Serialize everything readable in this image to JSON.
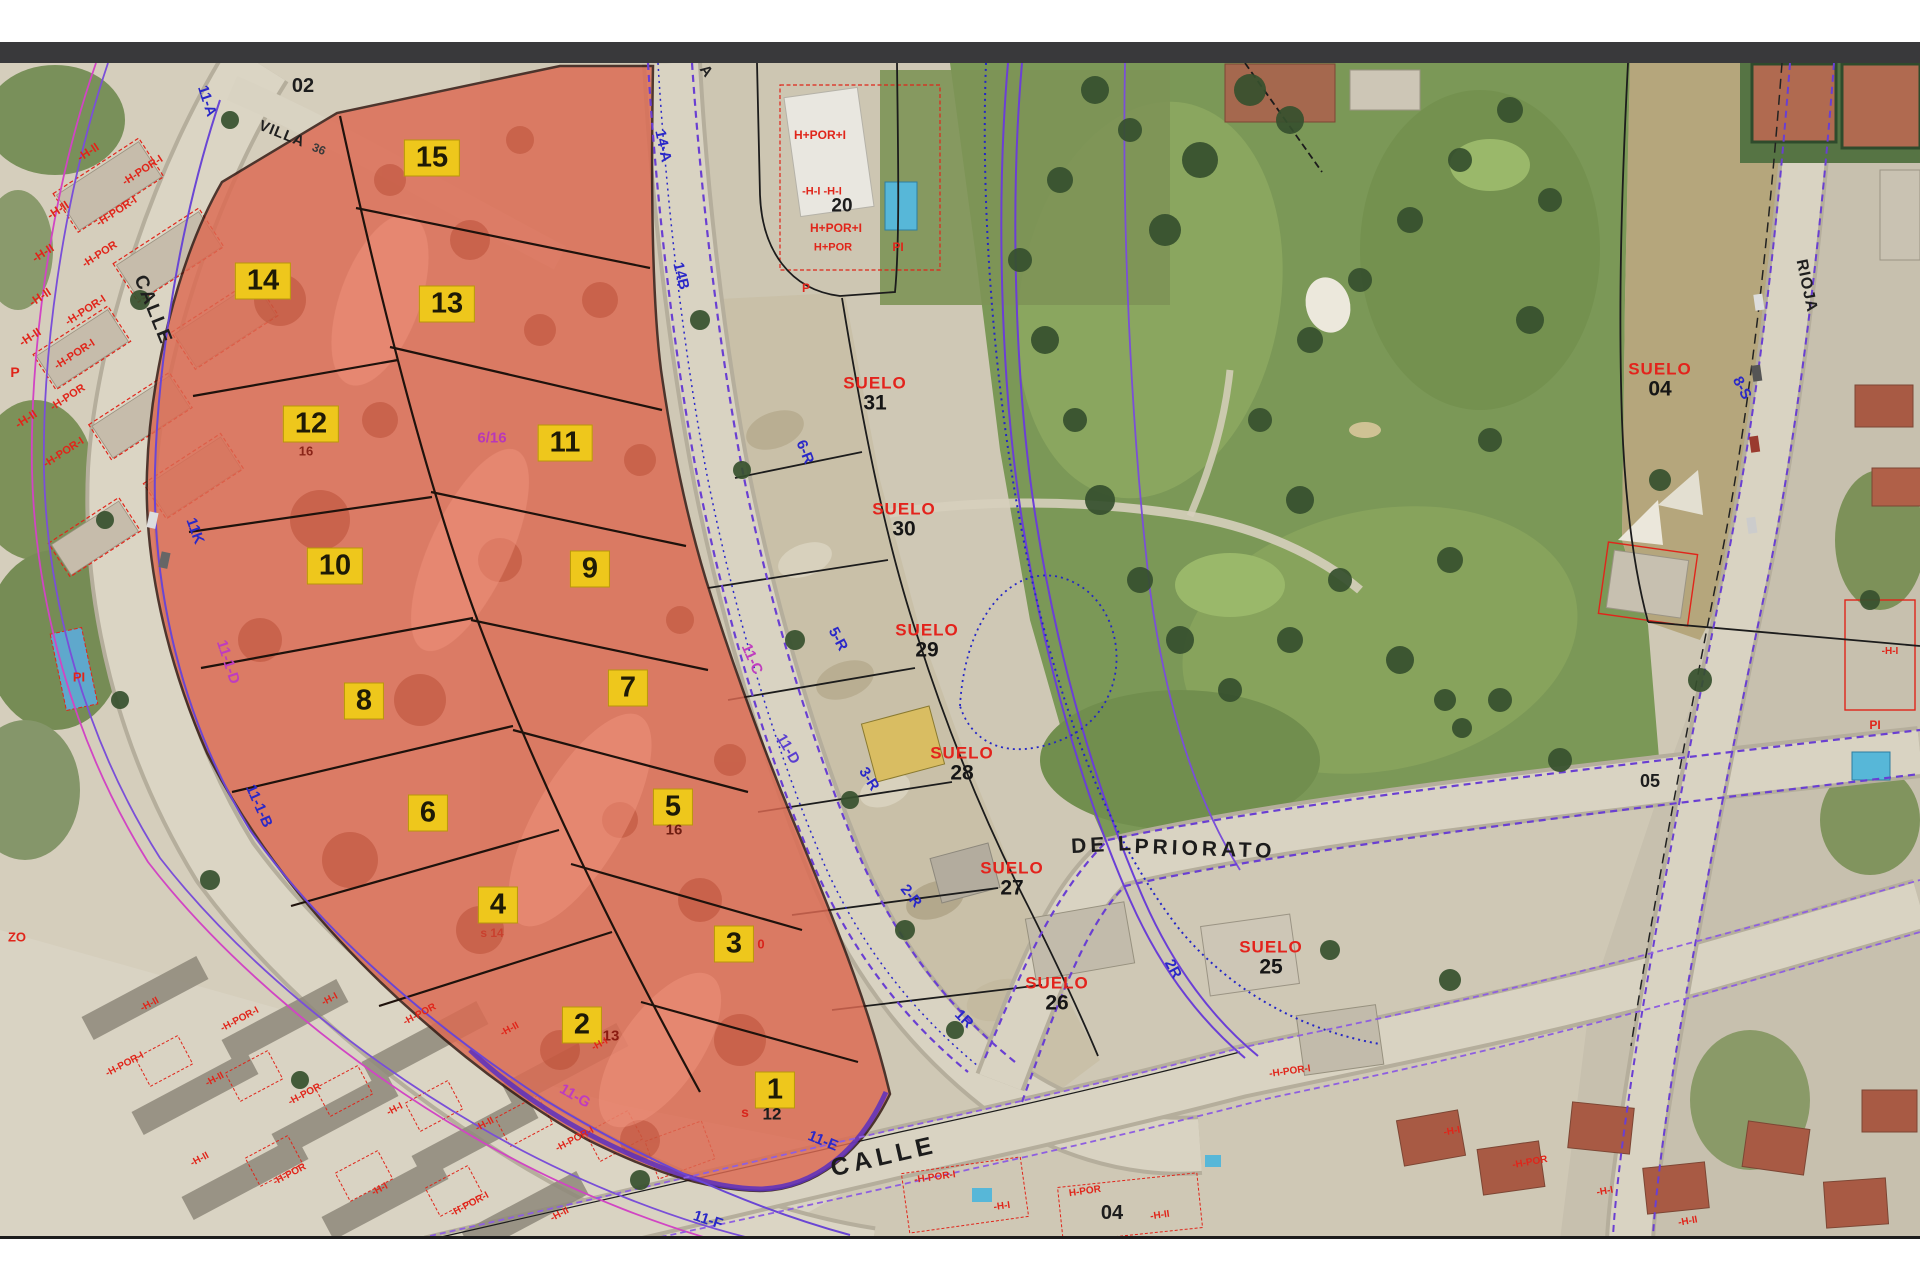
{
  "window": {
    "top_strip_color": "#ffffff",
    "title_bar_color": "#39393b"
  },
  "colors": {
    "highlight_polygon": "#dd6a52",
    "parcel_label_bg": "#eec71c",
    "suelo_red": "#e3231c",
    "code_blue": "#2a28c8",
    "code_magenta": "#bf3cbf",
    "overlay_purple": "#7a4fd8",
    "overlay_magenta": "#d145c4",
    "cadastral_red": "#e0251a"
  },
  "map": {
    "parcel_labels": [
      {
        "n": "1",
        "x": 775,
        "y": 1090
      },
      {
        "n": "2",
        "x": 582,
        "y": 1025
      },
      {
        "n": "3",
        "x": 734,
        "y": 944
      },
      {
        "n": "4",
        "x": 498,
        "y": 905
      },
      {
        "n": "5",
        "x": 673,
        "y": 807
      },
      {
        "n": "6",
        "x": 428,
        "y": 813
      },
      {
        "n": "7",
        "x": 628,
        "y": 688
      },
      {
        "n": "8",
        "x": 364,
        "y": 701
      },
      {
        "n": "9",
        "x": 590,
        "y": 569
      },
      {
        "n": "10",
        "x": 335,
        "y": 566
      },
      {
        "n": "11",
        "x": 565,
        "y": 443
      },
      {
        "n": "12",
        "x": 311,
        "y": 424
      },
      {
        "n": "13",
        "x": 447,
        "y": 304
      },
      {
        "n": "14",
        "x": 263,
        "y": 281
      },
      {
        "n": "15",
        "x": 432,
        "y": 158
      }
    ],
    "parcel_sub_numbers": [
      {
        "text": "6/16",
        "x": 492,
        "y": 438,
        "color": "#b838b8",
        "size": 15,
        "rot": 0
      },
      {
        "text": "16",
        "x": 306,
        "y": 451,
        "color": "#8a2417",
        "size": 13,
        "rot": 0
      },
      {
        "text": "16",
        "x": 674,
        "y": 830,
        "color": "#6e1d12",
        "size": 15,
        "rot": 0
      },
      {
        "text": "0",
        "x": 761,
        "y": 944,
        "color": "#d8251c",
        "size": 13,
        "rot": 0
      },
      {
        "text": "13",
        "x": 611,
        "y": 1036,
        "color": "#8a1a10",
        "size": 15,
        "rot": 0
      },
      {
        "text": "s 14",
        "x": 492,
        "y": 933,
        "color": "#c9402e",
        "size": 12,
        "rot": 0
      },
      {
        "text": "s",
        "x": 745,
        "y": 1112,
        "color": "#d8251c",
        "size": 14,
        "rot": 0
      },
      {
        "text": "12",
        "x": 772,
        "y": 1114,
        "color": "#1d1d1d",
        "size": 17,
        "rot": 0
      }
    ],
    "suelo_labels": [
      {
        "word": "SUELO",
        "num": "31",
        "x": 875,
        "y": 394
      },
      {
        "word": "SUELO",
        "num": "30",
        "x": 904,
        "y": 520
      },
      {
        "word": "SUELO",
        "num": "29",
        "x": 927,
        "y": 641
      },
      {
        "word": "SUELO",
        "num": "28",
        "x": 962,
        "y": 764
      },
      {
        "word": "SUELO",
        "num": "27",
        "x": 1012,
        "y": 879
      },
      {
        "word": "SUELO",
        "num": "26",
        "x": 1057,
        "y": 994
      },
      {
        "word": "SUELO",
        "num": "25",
        "x": 1271,
        "y": 958
      },
      {
        "word": "SUELO",
        "num": "04",
        "x": 1660,
        "y": 380
      }
    ],
    "street_labels": [
      {
        "text": "CALLE",
        "x": 153,
        "y": 310,
        "rot": 68,
        "size": 19,
        "spacing": 2,
        "color": "#1f1f1f"
      },
      {
        "text": "VILLA",
        "x": 282,
        "y": 134,
        "rot": 22,
        "size": 15,
        "spacing": 1,
        "color": "#1f1f1f"
      },
      {
        "text": "CALLE",
        "x": 884,
        "y": 1157,
        "rot": -13,
        "size": 25,
        "spacing": 5,
        "color": "#1c1c1c"
      },
      {
        "text": "DE L",
        "x": 1103,
        "y": 845,
        "rot": -3,
        "size": 21,
        "spacing": 4,
        "color": "#1c1c1c"
      },
      {
        "text": "PRIORATO",
        "x": 1205,
        "y": 849,
        "rot": 2,
        "size": 21,
        "spacing": 4,
        "color": "#1c1c1c"
      },
      {
        "text": "RIOJA",
        "x": 1806,
        "y": 286,
        "rot": 78,
        "size": 16,
        "spacing": 1,
        "color": "#1f1f1f"
      }
    ],
    "misc_labels": [
      {
        "text": "02",
        "x": 303,
        "y": 86,
        "size": 20,
        "color": "#1d1d1d",
        "rot": 0
      },
      {
        "text": "20",
        "x": 842,
        "y": 206,
        "size": 19,
        "color": "#1d1d1d",
        "rot": 0
      },
      {
        "text": "04",
        "x": 1112,
        "y": 1213,
        "size": 20,
        "color": "#1d1d1d",
        "rot": 0
      },
      {
        "text": "05",
        "x": 1650,
        "y": 781,
        "size": 18,
        "color": "#1d1d1d",
        "rot": 0
      },
      {
        "text": "36",
        "x": 319,
        "y": 149,
        "size": 12,
        "color": "#3a3a3a",
        "rot": 22
      },
      {
        "text": "A",
        "x": 706,
        "y": 71,
        "size": 15,
        "color": "#222222",
        "rot": 55
      }
    ],
    "road_codes": [
      {
        "text": "11-A",
        "x": 207,
        "y": 101,
        "rot": 72,
        "color": "#2a28c8"
      },
      {
        "text": "11K",
        "x": 195,
        "y": 531,
        "rot": 70,
        "color": "#2a28c8"
      },
      {
        "text": "11-1-D",
        "x": 228,
        "y": 662,
        "rot": 72,
        "color": "#bf3cbf"
      },
      {
        "text": "11-1-B",
        "x": 259,
        "y": 806,
        "rot": 66,
        "color": "#2a28c8"
      },
      {
        "text": "14-A",
        "x": 663,
        "y": 146,
        "rot": 78,
        "color": "#2a28c8"
      },
      {
        "text": "14B",
        "x": 681,
        "y": 276,
        "rot": 76,
        "color": "#2a28c8"
      },
      {
        "text": "6-R",
        "x": 805,
        "y": 452,
        "rot": 68,
        "color": "#2a28c8"
      },
      {
        "text": "5-R",
        "x": 838,
        "y": 639,
        "rot": 62,
        "color": "#2a28c8"
      },
      {
        "text": "3-R",
        "x": 869,
        "y": 779,
        "rot": 58,
        "color": "#2a28c8"
      },
      {
        "text": "2-R",
        "x": 911,
        "y": 896,
        "rot": 52,
        "color": "#2a28c8"
      },
      {
        "text": "1R",
        "x": 964,
        "y": 1019,
        "rot": 45,
        "color": "#2a28c8"
      },
      {
        "text": "2R",
        "x": 1173,
        "y": 969,
        "rot": 62,
        "color": "#2a28c8"
      },
      {
        "text": "11-C",
        "x": 752,
        "y": 659,
        "rot": 66,
        "color": "#bf3cbf"
      },
      {
        "text": "11-D",
        "x": 788,
        "y": 749,
        "rot": 60,
        "color": "#5a3fd0"
      },
      {
        "text": "11-G",
        "x": 575,
        "y": 1096,
        "rot": 30,
        "color": "#bf3cbf"
      },
      {
        "text": "11-E",
        "x": 823,
        "y": 1141,
        "rot": 22,
        "color": "#2a28c8"
      },
      {
        "text": "11-F",
        "x": 708,
        "y": 1220,
        "rot": 18,
        "color": "#2a28c8"
      },
      {
        "text": "8-S",
        "x": 1742,
        "y": 388,
        "rot": 62,
        "color": "#2a28c8"
      }
    ],
    "red_annotations": [
      {
        "text": "-H-II",
        "x": 88,
        "y": 152,
        "rot": -33,
        "size": 12
      },
      {
        "text": "-H-POR-I",
        "x": 143,
        "y": 171,
        "rot": -33,
        "size": 11
      },
      {
        "text": "-H-II",
        "x": 58,
        "y": 210,
        "rot": -33,
        "size": 12
      },
      {
        "text": "-H-POR-I",
        "x": 117,
        "y": 212,
        "rot": -33,
        "size": 11
      },
      {
        "text": "-H-II",
        "x": 43,
        "y": 253,
        "rot": -33,
        "size": 12
      },
      {
        "text": "-H-POR",
        "x": 100,
        "y": 255,
        "rot": -33,
        "size": 11
      },
      {
        "text": "-H-II",
        "x": 40,
        "y": 297,
        "rot": -33,
        "size": 12
      },
      {
        "text": "-H-POR-I",
        "x": 86,
        "y": 311,
        "rot": -33,
        "size": 11
      },
      {
        "text": "-H-II",
        "x": 30,
        "y": 337,
        "rot": -33,
        "size": 12
      },
      {
        "text": "-H-POR-I",
        "x": 75,
        "y": 355,
        "rot": -33,
        "size": 11
      },
      {
        "text": "-H-POR",
        "x": 68,
        "y": 398,
        "rot": -33,
        "size": 11
      },
      {
        "text": "-H-II",
        "x": 26,
        "y": 419,
        "rot": -33,
        "size": 12
      },
      {
        "text": "-H-POR-I",
        "x": 64,
        "y": 453,
        "rot": -33,
        "size": 11
      },
      {
        "text": "P",
        "x": 15,
        "y": 372,
        "rot": 0,
        "size": 14
      },
      {
        "text": "PI",
        "x": 79,
        "y": 677,
        "rot": 0,
        "size": 13
      },
      {
        "text": "ZO",
        "x": 17,
        "y": 937,
        "rot": 0,
        "size": 13
      },
      {
        "text": "H+POR+I",
        "x": 820,
        "y": 135,
        "rot": 0,
        "size": 12
      },
      {
        "text": "-H-I  -H-I",
        "x": 822,
        "y": 192,
        "rot": 0,
        "size": 11
      },
      {
        "text": "H+POR+I",
        "x": 836,
        "y": 228,
        "rot": 0,
        "size": 12
      },
      {
        "text": "H+POR",
        "x": 833,
        "y": 248,
        "rot": 0,
        "size": 11
      },
      {
        "text": "PI",
        "x": 898,
        "y": 247,
        "rot": 0,
        "size": 12
      },
      {
        "text": "P",
        "x": 806,
        "y": 288,
        "rot": 0,
        "size": 12
      },
      {
        "text": "-H-II",
        "x": 150,
        "y": 1005,
        "rot": -28,
        "size": 10
      },
      {
        "text": "-H-POR-I",
        "x": 240,
        "y": 1020,
        "rot": -28,
        "size": 10
      },
      {
        "text": "-H-I",
        "x": 330,
        "y": 1000,
        "rot": -28,
        "size": 10
      },
      {
        "text": "-H-POR",
        "x": 420,
        "y": 1015,
        "rot": -28,
        "size": 10
      },
      {
        "text": "-H-II",
        "x": 510,
        "y": 1030,
        "rot": -28,
        "size": 10
      },
      {
        "text": "-H-I",
        "x": 600,
        "y": 1045,
        "rot": -28,
        "size": 10
      },
      {
        "text": "-H-POR-I",
        "x": 125,
        "y": 1065,
        "rot": -28,
        "size": 10
      },
      {
        "text": "-H-II",
        "x": 215,
        "y": 1080,
        "rot": -28,
        "size": 10
      },
      {
        "text": "-H-POR",
        "x": 305,
        "y": 1095,
        "rot": -28,
        "size": 10
      },
      {
        "text": "-H-I",
        "x": 395,
        "y": 1110,
        "rot": -28,
        "size": 10
      },
      {
        "text": "-H-II",
        "x": 485,
        "y": 1125,
        "rot": -28,
        "size": 10
      },
      {
        "text": "-H-POR-I",
        "x": 575,
        "y": 1140,
        "rot": -28,
        "size": 10
      },
      {
        "text": "-H-II",
        "x": 200,
        "y": 1160,
        "rot": -28,
        "size": 10
      },
      {
        "text": "-H-POR",
        "x": 290,
        "y": 1175,
        "rot": -28,
        "size": 10
      },
      {
        "text": "-H-I",
        "x": 380,
        "y": 1190,
        "rot": -28,
        "size": 10
      },
      {
        "text": "-H-POR-I",
        "x": 470,
        "y": 1205,
        "rot": -28,
        "size": 10
      },
      {
        "text": "-H-II",
        "x": 560,
        "y": 1215,
        "rot": -28,
        "size": 10
      },
      {
        "text": "-H-POR-I",
        "x": 935,
        "y": 1178,
        "rot": -8,
        "size": 10
      },
      {
        "text": "-H-I",
        "x": 1002,
        "y": 1207,
        "rot": -8,
        "size": 10
      },
      {
        "text": "H-POR",
        "x": 1085,
        "y": 1192,
        "rot": -8,
        "size": 10
      },
      {
        "text": "-H-II",
        "x": 1160,
        "y": 1216,
        "rot": -8,
        "size": 10
      },
      {
        "text": "-H-POR-I",
        "x": 1290,
        "y": 1072,
        "rot": -8,
        "size": 10
      },
      {
        "text": "PI",
        "x": 1875,
        "y": 725,
        "rot": 0,
        "size": 12
      },
      {
        "text": "-H-I",
        "x": 1890,
        "y": 652,
        "rot": 0,
        "size": 10
      },
      {
        "text": "-H-I",
        "x": 1452,
        "y": 1132,
        "rot": -10,
        "size": 10
      },
      {
        "text": "-H-POR",
        "x": 1530,
        "y": 1163,
        "rot": -10,
        "size": 10
      },
      {
        "text": "-H-I",
        "x": 1605,
        "y": 1192,
        "rot": -10,
        "size": 10
      },
      {
        "text": "-H-II",
        "x": 1688,
        "y": 1222,
        "rot": -10,
        "size": 10
      }
    ]
  }
}
